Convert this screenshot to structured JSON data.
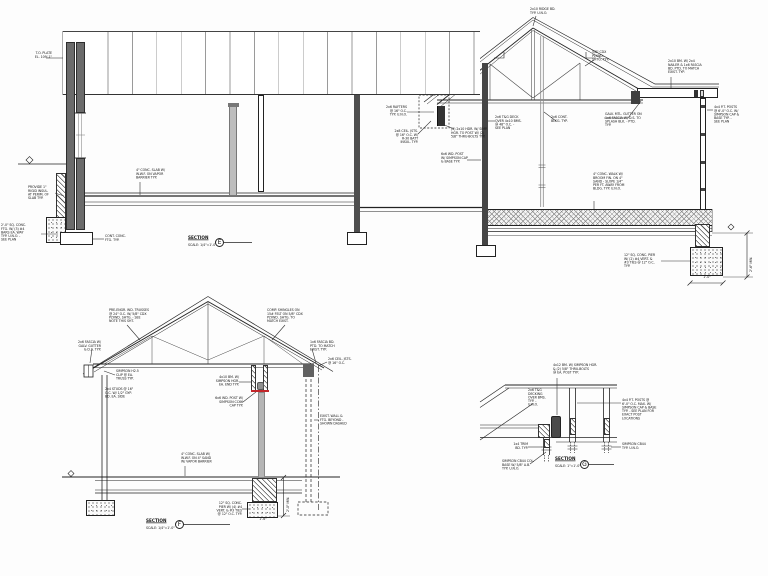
{
  "drawing": {
    "type": "architectural-building-sections",
    "background": "#fdfdfd",
    "line_color": "#222222",
    "wall_fill": "#6b6b6b",
    "column_fill": "#454545",
    "post_gray": "#b5b5b5",
    "accent_red": "#c2262a"
  },
  "bubbles": [
    {
      "id": "bubble-e",
      "letter": "E",
      "x": 215,
      "y": 238
    },
    {
      "id": "bubble-f",
      "letter": "F",
      "x": 175,
      "y": 520
    },
    {
      "id": "bubble-g",
      "letter": "G",
      "x": 580,
      "y": 460
    }
  ],
  "annotations": [
    {
      "id": "t-top-plate",
      "x": 24,
      "y": 52,
      "w": 28,
      "align": "r",
      "text": "T.O. PLATE\nEL. 109'-1\""
    },
    {
      "id": "t-rigid-insul",
      "x": 28,
      "y": 186,
      "w": 27,
      "align": "l",
      "text": "PROVIDE 1\"\nRIGID INSUL.\nAT PERIM. OF\nSLAB TYP.",
      "leader": [
        55,
        193,
        64,
        196
      ]
    },
    {
      "id": "t-sq-ftg",
      "x": 1,
      "y": 224,
      "w": 40,
      "align": "l",
      "text": "2'-0\" SQ. CONC.\nFTG. W/ (3) #4\nBARS EA. WAY\nTYP. U.N.O. -\nSEE PLAN",
      "leader": [
        41,
        234,
        58,
        234
      ]
    },
    {
      "id": "t-cont-ftg",
      "x": 105,
      "y": 235,
      "w": 27,
      "align": "l",
      "text": "CONT. CONC.\nFTG. TYP.",
      "leader": [
        104,
        239,
        92,
        239
      ]
    },
    {
      "id": "t-slab",
      "x": 136,
      "y": 169,
      "w": 38,
      "align": "l",
      "text": "4\" CONC. SLAB W/\nW.W.F. ON VAPOR\nBARRIER TYP.",
      "leader": [
        140,
        182,
        140,
        195
      ]
    },
    {
      "id": "t-rafters",
      "x": 382,
      "y": 106,
      "w": 25,
      "align": "r",
      "text": "2x6 RAFTERS\n@ 16\" O.C.\nTYP. U.N.O.",
      "leader": [
        407,
        112,
        434,
        112
      ]
    },
    {
      "id": "t-cjsts",
      "x": 391,
      "y": 130,
      "w": 27,
      "align": "r",
      "text": "2x8 CEIL. JSTS.\n@ 16\" O.C. W/\nR-30 BATT\nINSUL. TYP.",
      "leader": [
        418,
        134,
        431,
        121
      ]
    },
    {
      "id": "t-hgr",
      "x": 451,
      "y": 128,
      "w": 41,
      "align": "l",
      "text": "(2) 2x10 HDR. W/ SIMP.\nHGR. TO POST W/ (2)\n5/8\" THRU-BOLTS TYP.",
      "leader": [
        454,
        129,
        442,
        124
      ]
    },
    {
      "id": "t-post",
      "x": 441,
      "y": 153,
      "w": 29,
      "align": "l",
      "text": "6x6 WD. POST\nW/ SIMPSON CAP\n& BASE TYP.",
      "leader": [
        467,
        160,
        481,
        160
      ]
    },
    {
      "id": "t-deck",
      "x": 495,
      "y": 116,
      "w": 31,
      "align": "l",
      "text": "2x6 T&G DECK\nOVER 4x10 BMS.\n@ 48\" O.C. -\nSEE PLAN",
      "leader": [
        495,
        121,
        488,
        121
      ]
    },
    {
      "id": "t-blkg",
      "x": 551,
      "y": 116,
      "w": 24,
      "align": "l",
      "text": "2x6 CONT.\nBLKG. TYP.",
      "leader": [
        556,
        121,
        544,
        112
      ]
    },
    {
      "id": "t-ridge",
      "x": 530,
      "y": 8,
      "w": 29,
      "align": "l",
      "text": "2x10 RIDGE BD.\nTYP. U.N.O.",
      "leader": [
        536,
        16,
        533,
        26
      ]
    },
    {
      "id": "t-shtg",
      "x": 592,
      "y": 51,
      "w": 22,
      "align": "l",
      "text": "5/8\" CDX\nPLYWD.\nSHTG. TYP.",
      "leader": [
        594,
        60,
        585,
        66
      ]
    },
    {
      "id": "t-fascia",
      "x": 668,
      "y": 60,
      "w": 46,
      "align": "l",
      "text": "2x10 BM. W/ 2x4\nNAILER & 1x6 FASCIA\nBD. PTD. TO MATCH\nEXIST. TYP.",
      "leader": [
        671,
        77,
        671,
        88
      ]
    },
    {
      "id": "t-gutter",
      "x": 605,
      "y": 113,
      "w": 45,
      "align": "l",
      "text": "GALV. MTL. GUTTER ON\n1x6 FASCIA W/ D.S. TO\nSPLASH BLK. - PTD.\nTYP.",
      "leader": [
        604,
        118,
        628,
        118,
        641,
        101
      ]
    },
    {
      "id": "t-posts-r",
      "x": 714,
      "y": 106,
      "w": 42,
      "align": "l",
      "text": "4x4 P.T. POSTS\n@ 6'-0\" O.C. W/\nSIMPSON CAP &\nBASE TYP. -\nSEE PLAN",
      "leader": [
        713,
        110,
        707,
        110
      ]
    },
    {
      "id": "t-walk",
      "x": 593,
      "y": 173,
      "w": 45,
      "align": "l",
      "text": "4\" CONC. WALK W/\nBROOM FIN. ON 4\"\nSAND - SLOPE 1/4\"\nPER FT. AWAY FROM\nBLDG. TYP. U.N.O.",
      "leader": [
        594,
        201,
        594,
        209
      ]
    },
    {
      "id": "t-pier",
      "x": 624,
      "y": 254,
      "w": 38,
      "align": "l",
      "text": "12\" SQ. CONC. PIER\nW/ (2) #4 VERT. &\n#3 TIES @ 12\" O.C.\nTYP.",
      "leader": [
        661,
        261,
        690,
        261
      ]
    },
    {
      "id": "t-dim-v",
      "x": 750,
      "y": 272,
      "rot": true,
      "text": "2'-6\" MIN."
    },
    {
      "id": "t-dim-h",
      "x": 692,
      "y": 276,
      "w": 30,
      "align": "c",
      "text": "1'-0\""
    },
    {
      "id": "e-title",
      "x": 188,
      "y": 236,
      "cls": "ttl",
      "text": "SECTION"
    },
    {
      "id": "e-scale",
      "x": 188,
      "y": 244,
      "w": 34,
      "align": "l",
      "text": "SCALE: 1/4\"=1'-0\""
    },
    {
      "id": "f-truss-l",
      "x": 109,
      "y": 309,
      "w": 43,
      "align": "l",
      "text": "PRE-ENGR. WD. TRUSSES\n@ 24\" O.C. W/ 5/8\" CDX\nPLYWD. SHTG. - SEE\nNOTE THIS SHT.",
      "leader": [
        127,
        325,
        140,
        340
      ]
    },
    {
      "id": "f-truss-r",
      "x": 267,
      "y": 309,
      "w": 43,
      "align": "l",
      "text": "COMP. SHINGLES ON\n15# FELT ON 5/8\" CDX\nPLYWD. SHTG. TO\nMATCH EXIST.",
      "leader": [
        285,
        325,
        272,
        340
      ]
    },
    {
      "id": "f-eave-l",
      "x": 72,
      "y": 341,
      "w": 29,
      "align": "r",
      "text": "2x6 FASCIA W/\nGALV. GUTTER\n& D.S. TYP.",
      "leader": [
        92,
        349,
        90,
        363
      ]
    },
    {
      "id": "f-eave-r",
      "x": 310,
      "y": 341,
      "w": 31,
      "align": "l",
      "text": "1x6 FASCIA BD.\nPTD. TO MATCH\nEXIST. TYP.",
      "leader": [
        312,
        349,
        316,
        363
      ]
    },
    {
      "id": "f-clip",
      "x": 116,
      "y": 370,
      "w": 31,
      "align": "l",
      "text": "SIMPSON H2.5\nCLIP @ EA.\nTRUSS TYP.",
      "leader": [
        115,
        375,
        104,
        371
      ]
    },
    {
      "id": "f-studs",
      "x": 105,
      "y": 388,
      "w": 30,
      "align": "l",
      "text": "2x4 STUDS @ 16\"\nO.C. W/ 1/2\" GYP.\nBD. EA. SIDE"
    },
    {
      "id": "f-bm",
      "x": 212,
      "y": 376,
      "w": 27,
      "align": "r",
      "text": "4x10 BM. W/\nSIMPSON HGR.\nEA. END TYP.",
      "leader": [
        239,
        382,
        251,
        382
      ]
    },
    {
      "id": "f-post",
      "x": 210,
      "y": 397,
      "w": 33,
      "align": "r",
      "text": "6x6 WD. POST W/\nSIMPSON CC66\nCAP TYP.",
      "leader": [
        243,
        402,
        256,
        392
      ]
    },
    {
      "id": "f-cjst",
      "x": 328,
      "y": 358,
      "w": 31,
      "align": "l",
      "text": "2x6 CEIL. JSTS.\n@ 16\" O.C.",
      "leader": [
        327,
        362,
        318,
        366
      ]
    },
    {
      "id": "f-dashed",
      "x": 320,
      "y": 415,
      "w": 34,
      "align": "l",
      "text": "EXIST. WALL &\nFTG. BEYOND -\nSHOWN DASHED",
      "leader": [
        319,
        420,
        314,
        420
      ]
    },
    {
      "id": "f-slab",
      "x": 181,
      "y": 453,
      "w": 37,
      "align": "l",
      "text": "4\" CONC. SLAB W/\nW.W.F. ON 4\" SAND\nW/ VAPOR BARRIER",
      "leader": [
        185,
        466,
        185,
        476
      ]
    },
    {
      "id": "f-pier",
      "x": 207,
      "y": 502,
      "w": 35,
      "align": "r",
      "text": "12\" SQ. CONC.\nPIER W/ (4) #4\nVERT. & #3 TIES\n@ 12\" O.C. TYP.",
      "leader": [
        242,
        509,
        250,
        509
      ]
    },
    {
      "id": "f-dim-v",
      "x": 287,
      "y": 512,
      "rot": true,
      "text": "2'-0\" MIN."
    },
    {
      "id": "f-dim-h",
      "x": 248,
      "y": 518,
      "w": 30,
      "align": "c",
      "text": "1'-6\""
    },
    {
      "id": "f-title",
      "x": 146,
      "y": 519,
      "cls": "ttl",
      "text": "SECTION"
    },
    {
      "id": "f-scale",
      "x": 146,
      "y": 527,
      "w": 34,
      "align": "l",
      "text": "SCALE: 1/4\"=1'-0\""
    },
    {
      "id": "g-bm",
      "x": 553,
      "y": 364,
      "w": 53,
      "align": "l",
      "text": "4x12 BM. W/ SIMPSON HGR.\n& (2) 5/8\" THRU-BOLTS\n@ EA. POST TYP.",
      "leader": [
        557,
        378,
        557,
        415
      ]
    },
    {
      "id": "g-deck",
      "x": 528,
      "y": 389,
      "w": 21,
      "align": "l",
      "text": "2x6 T&G\nDECKING\nOVER BMS.\nTYP. -\nU.N.O."
    },
    {
      "id": "g-posts",
      "x": 622,
      "y": 399,
      "w": 41,
      "align": "l",
      "text": "4x4 P.T. POSTS @\n6'-0\" O.C. MAX. W/\nSIMPSON CAP & BASE\nTYP. - SEE PLAN FOR\nEXACT POST\nLOCATIONS",
      "leader": [
        621,
        403,
        577,
        403
      ]
    },
    {
      "id": "g-trim",
      "x": 503,
      "y": 443,
      "w": 25,
      "align": "r",
      "text": "1x4 TRIM\nBD. TYP.",
      "leader": [
        528,
        447,
        542,
        447
      ]
    },
    {
      "id": "g-base",
      "x": 502,
      "y": 460,
      "w": 37,
      "align": "l",
      "text": "SIMPSON CB44 COL.\nBASE W/ 5/8\" A.B.\nTYP. U.N.O.",
      "leader": [
        530,
        464,
        546,
        452
      ]
    },
    {
      "id": "g-base-r",
      "x": 622,
      "y": 443,
      "w": 31,
      "align": "l",
      "text": "SIMPSON CB44\nTYP. U.N.O.",
      "leader": [
        621,
        447,
        611,
        447
      ]
    },
    {
      "id": "g-title",
      "x": 555,
      "y": 457,
      "cls": "ttl",
      "text": "SECTION"
    },
    {
      "id": "g-scale",
      "x": 555,
      "y": 465,
      "w": 30,
      "align": "l",
      "text": "SCALE: 1\"=1'-0\""
    }
  ]
}
